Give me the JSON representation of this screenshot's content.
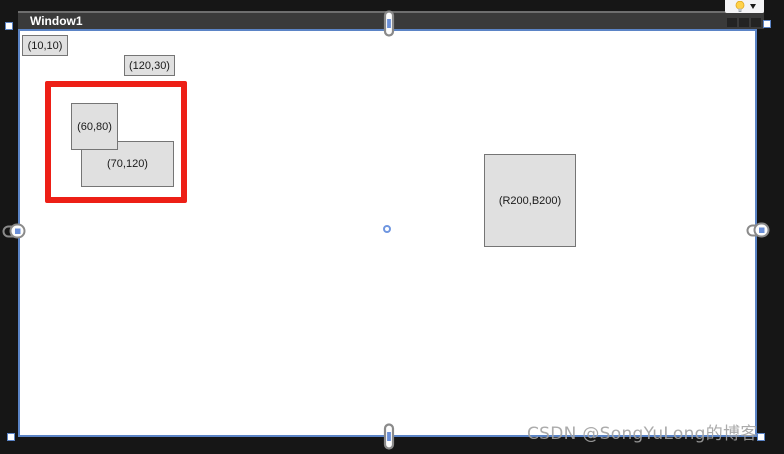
{
  "window": {
    "title": "Window1"
  },
  "controls": {
    "labels": [
      {
        "text": "(10,10)"
      },
      {
        "text": "(120,30)"
      }
    ],
    "boxes": [
      {
        "text": "(60,80)"
      },
      {
        "text": "(70,120)"
      },
      {
        "text": "(R200,B200)"
      }
    ]
  },
  "watermark": {
    "text": "CSDN @SongYuLong的博客"
  },
  "icons": {
    "lightbulb": "quick-actions bulb",
    "chevron_down": "▾",
    "anchor_link": "chain-link",
    "center_point": "○"
  },
  "colors": {
    "selection_blue": "#5b84c6",
    "highlight_red": "#ed1f16",
    "control_fill": "#e0e0e0",
    "control_border": "#757575",
    "titlebar": "#3a3a3a",
    "canvas": "#ffffff",
    "background": "#161616"
  }
}
